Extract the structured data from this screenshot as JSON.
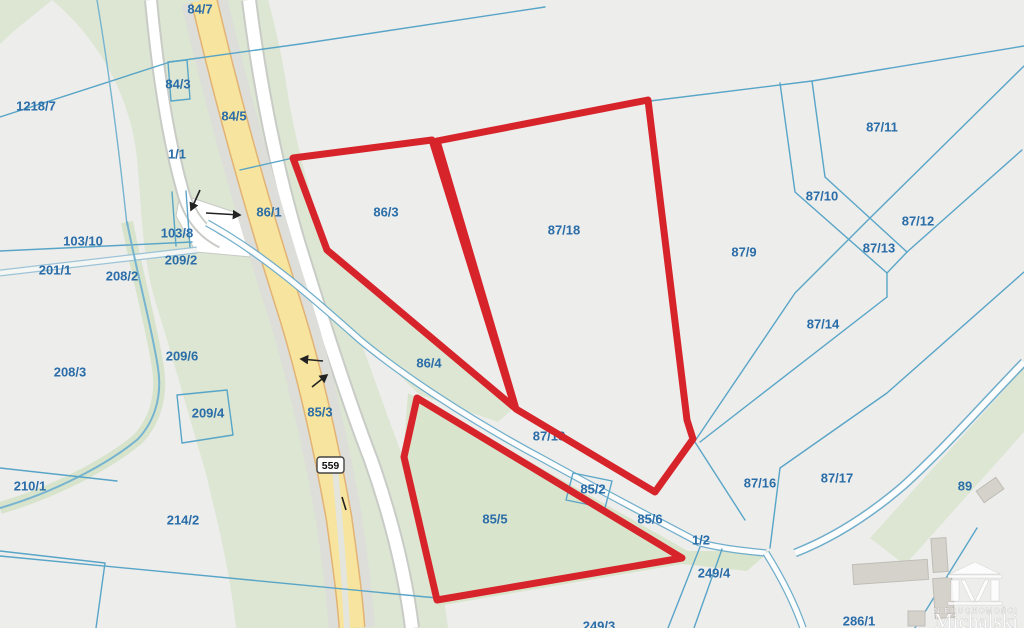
{
  "map_view": {
    "route_shield": {
      "number": "559"
    },
    "watermark": {
      "brand_top": "NIERUCHOMOŚCI",
      "brand_name": "Michalski"
    },
    "colors": {
      "background": "#EDEDEB",
      "parcel_line": "#58A5C8",
      "label_text": "#2A6DA8",
      "highlight": "#D7242B",
      "road_yellow": "#F7E49E",
      "road_yellow_edge": "#E2B374",
      "road_gray": "#DDDDD9",
      "road_white": "#FFFFFF",
      "greenery": "#DCE6D2",
      "greenery_dark": "#D9E4CC"
    },
    "parcel_labels": [
      {
        "text": "84/7",
        "x": 200,
        "y": 9
      },
      {
        "text": "84/3",
        "x": 178,
        "y": 84
      },
      {
        "text": "1218/7",
        "x": 36,
        "y": 106
      },
      {
        "text": "84/5",
        "x": 234,
        "y": 116
      },
      {
        "text": "87/11",
        "x": 882,
        "y": 127
      },
      {
        "text": "1/1",
        "x": 177,
        "y": 154
      },
      {
        "text": "87/10",
        "x": 822,
        "y": 196
      },
      {
        "text": "86/1",
        "x": 269,
        "y": 212
      },
      {
        "text": "86/3",
        "x": 386,
        "y": 212
      },
      {
        "text": "87/12",
        "x": 918,
        "y": 221
      },
      {
        "text": "103/10",
        "x": 83,
        "y": 241
      },
      {
        "text": "103/8",
        "x": 177,
        "y": 233
      },
      {
        "text": "87/13",
        "x": 879,
        "y": 248
      },
      {
        "text": "87/9",
        "x": 744,
        "y": 252
      },
      {
        "text": "209/2",
        "x": 181,
        "y": 260
      },
      {
        "text": "201/1",
        "x": 55,
        "y": 270
      },
      {
        "text": "208/2",
        "x": 122,
        "y": 276
      },
      {
        "text": "87/18",
        "x": 564,
        "y": 230
      },
      {
        "text": "87/14",
        "x": 823,
        "y": 324
      },
      {
        "text": "209/6",
        "x": 182,
        "y": 356
      },
      {
        "text": "208/3",
        "x": 70,
        "y": 372
      },
      {
        "text": "86/4",
        "x": 429,
        "y": 363
      },
      {
        "text": "85/3",
        "x": 320,
        "y": 412
      },
      {
        "text": "209/4",
        "x": 208,
        "y": 413
      },
      {
        "text": "87/18",
        "x": 549,
        "y": 436
      },
      {
        "text": "87/16",
        "x": 760,
        "y": 483
      },
      {
        "text": "87/17",
        "x": 837,
        "y": 478
      },
      {
        "text": "89",
        "x": 965,
        "y": 486
      },
      {
        "text": "210/1",
        "x": 30,
        "y": 486
      },
      {
        "text": "85/2",
        "x": 593,
        "y": 489
      },
      {
        "text": "85/5",
        "x": 495,
        "y": 519
      },
      {
        "text": "85/6",
        "x": 650,
        "y": 519
      },
      {
        "text": "214/2",
        "x": 183,
        "y": 520
      },
      {
        "text": "1/2",
        "x": 701,
        "y": 540
      },
      {
        "text": "249/4",
        "x": 714,
        "y": 573
      },
      {
        "text": "286/1",
        "x": 859,
        "y": 621
      },
      {
        "text": "249/3",
        "x": 599,
        "y": 626
      }
    ],
    "highlighted_parcels": [
      {
        "name": "parcel-86-3",
        "points": "293,158 432,140 515,408 327,250"
      },
      {
        "name": "parcel-87-18",
        "points": "437,141 648,100 687,420 693,439 655,492 516,409"
      },
      {
        "name": "parcel-85-5",
        "points": "417,398 682,558 437,600 404,457"
      }
    ]
  }
}
